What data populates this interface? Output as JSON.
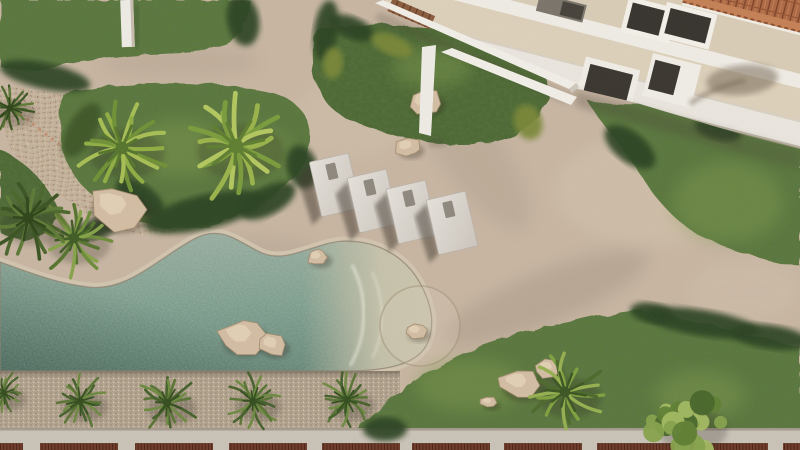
{
  "scene": {
    "title": "Resort courtyard aerial render",
    "description": "Top-down 3D architectural rendering of a resort garden: free-form pool with boulders, four sun loungers on sand, palm trees, lawns, a white building with terracotta tile roof, and a palm-lined pebble promenade with red pergola bays",
    "view": "top-down aerial",
    "style": "photorealistic 3D render"
  },
  "palette": {
    "sand": "#c8b6a3",
    "sand_light": "#d8c9b3",
    "sand_shadow": "#8f8273",
    "grass_mid": "#5a783e",
    "grass_dark": "#4c6833",
    "bush_dark": "#2c4220",
    "bush_olive": "#3c5526",
    "bush_yellow": "#7a8838",
    "water": "#7b9c8c",
    "water_deep": "#2c483e",
    "coping": "#d2c5b0",
    "pebble": "#b3a490",
    "gravel": "#c3b29c",
    "walkway": "#cac3b8",
    "pergola_red": "#6e3a28",
    "building_wall": "#efece5",
    "building_terrace": "#ddd1bc",
    "opening_dark": "#36332e",
    "roof_terracotta": "#ad6844",
    "rock": "#d3bea4",
    "lounger": "#ddd8d1",
    "beam_white": "#f2efe9"
  },
  "palettes": {
    "bright": [
      "#8fae43",
      "#6f9136",
      "#a7bf55",
      "#55752c"
    ],
    "bright2": [
      "#9ab44a",
      "#7a9c3c",
      "#b3c75f",
      "#5e7e30"
    ],
    "mid": [
      "#6d8c3a",
      "#55742e",
      "#86a348",
      "#3f5c24"
    ],
    "darkset": [
      "#4a662c",
      "#3a5322",
      "#5d7a36",
      "#2e4419"
    ],
    "prom": [
      "#587434",
      "#43602a",
      "#6d8a40",
      "#334d1e"
    ],
    "mixed": [
      "#7fa03f",
      "#4c682c",
      "#95b050",
      "#3a5522"
    ],
    "tree": [
      "#86a24c",
      "#5f7f34",
      "#a3bb62",
      "#47662a"
    ]
  },
  "pool": {
    "path": "M0,262 C28,272 55,283 88,287 C128,292 158,258 196,238 C222,225 238,242 262,253 C288,264 315,242 345,241 C382,241 408,260 421,285 C432,305 436,327 426,346 C415,365 385,371 345,371 L0,371 Z",
    "water": "#7b9c8c",
    "boulders_in_pool": 2,
    "beach_entry_side": "right"
  },
  "terrain": {
    "grass_tones": {
      "mid": "#5a783e",
      "dark": "#4c6833"
    },
    "grass_paths": [
      {
        "name": "lawn-top-left",
        "tone": "mid",
        "d": "M0,0 L250,0 C246,18 248,34 232,44 C196,58 150,50 98,60 C58,66 28,76 0,66 Z"
      },
      {
        "name": "lawn-palm-island",
        "tone": "mid",
        "d": "M64,96 C120,78 205,80 266,92 C306,100 316,126 306,156 C296,188 266,204 228,220 C198,234 158,231 128,217 C94,201 68,178 62,148 C58,128 58,108 64,96 Z"
      },
      {
        "name": "lawn-left-edge",
        "tone": "dark",
        "d": "M0,150 C20,158 40,176 52,196 C60,212 58,228 44,236 C30,242 12,240 0,232 Z"
      },
      {
        "name": "lawn-top-middle",
        "tone": "dark",
        "d": "M318,30 C358,22 420,24 468,34 C510,42 545,58 548,88 C550,116 524,136 490,142 C448,150 392,138 354,122 C330,112 317,95 314,72 C312,55 312,38 318,30 Z"
      },
      {
        "name": "lawn-right",
        "tone": "mid",
        "d": "M585,98 C620,112 650,100 688,108 C720,114 754,132 800,146 L800,266 C765,260 735,252 708,240 C678,226 652,196 636,168 C620,142 598,120 585,98 Z"
      },
      {
        "name": "lawn-bottom",
        "tone": "mid",
        "d": "M357,430 C378,402 418,376 456,356 C496,336 540,329 576,321 C606,314 628,309 646,311 L800,346 L800,430 Z"
      }
    ],
    "gravel_path": "M0,90 C35,84 68,94 88,112 C120,142 160,180 182,204 C192,218 186,232 170,234 C150,236 128,234 112,226 C70,205 30,180 12,150 C2,132 0,110 0,90 Z",
    "highlights": [
      {
        "x": 728,
        "y": 202,
        "rx": 55,
        "ry": 40
      },
      {
        "x": 180,
        "y": 148,
        "rx": 48,
        "ry": 28
      },
      {
        "x": 432,
        "y": 68,
        "rx": 40,
        "ry": 20
      },
      {
        "x": 470,
        "y": 385,
        "rx": 55,
        "ry": 26
      },
      {
        "x": 700,
        "y": 395,
        "rx": 45,
        "ry": 24
      },
      {
        "x": 250,
        "y": 150,
        "rx": 40,
        "ry": 24
      }
    ]
  },
  "promenade": {
    "pebble_top": 371,
    "walkway_top": 428,
    "bay_top": 443.4,
    "bay_height": 6.8,
    "bay_width": 78,
    "bay_starts": [
      -55,
      40,
      135,
      229,
      322,
      412,
      504,
      597,
      690,
      783
    ],
    "palm_count": 5
  },
  "building": {
    "wall": "#efece5",
    "terrace": "#ddd1bc",
    "terrace_upper": "#e2d7c3",
    "opening": "#36332e",
    "roof": "#ad6844",
    "roof_rib": "#7d4127",
    "roof_ridge": "#c58055",
    "angle_deg": 14.3,
    "window_count": 4
  },
  "objects": {
    "sand_circle": {
      "x": 420,
      "y": 326,
      "r": 40
    },
    "bushes": [
      {
        "x": 243,
        "y": 20,
        "rx": 16,
        "ry": 26,
        "rot": -10,
        "c": "dark"
      },
      {
        "x": 326,
        "y": 30,
        "rx": 12,
        "ry": 30,
        "rot": 8,
        "c": "dark"
      },
      {
        "x": 333,
        "y": 63,
        "rx": 10,
        "ry": 16,
        "rot": 5,
        "c": "yellow"
      },
      {
        "x": 352,
        "y": 28,
        "rx": 24,
        "ry": 11,
        "rot": 22,
        "c": "dark"
      },
      {
        "x": 392,
        "y": 45,
        "rx": 22,
        "ry": 10,
        "rot": 22,
        "c": "yellow"
      },
      {
        "x": 528,
        "y": 122,
        "rx": 14,
        "ry": 18,
        "rot": -20,
        "c": "yellow"
      },
      {
        "x": 45,
        "y": 76,
        "rx": 46,
        "ry": 13,
        "rot": 12,
        "c": "dark"
      },
      {
        "x": 82,
        "y": 130,
        "rx": 14,
        "ry": 30,
        "rot": 30,
        "c": "olive"
      },
      {
        "x": 140,
        "y": 198,
        "rx": 28,
        "ry": 14,
        "rot": 35,
        "c": "dark"
      },
      {
        "x": 205,
        "y": 212,
        "rx": 62,
        "ry": 17,
        "rot": -13,
        "c": "dark"
      },
      {
        "x": 268,
        "y": 201,
        "rx": 30,
        "ry": 14,
        "rot": -28,
        "c": "dark"
      },
      {
        "x": 302,
        "y": 167,
        "rx": 15,
        "ry": 22,
        "rot": -15,
        "c": "dark"
      },
      {
        "x": 98,
        "y": 228,
        "rx": 26,
        "ry": 10,
        "rot": -18,
        "c": "dark"
      },
      {
        "x": 630,
        "y": 147,
        "rx": 30,
        "ry": 15,
        "rot": 38,
        "c": "dark"
      },
      {
        "x": 718,
        "y": 130,
        "rx": 24,
        "ry": 10,
        "rot": 14,
        "c": "dark"
      },
      {
        "x": 652,
        "y": 313,
        "rx": 22,
        "ry": 10,
        "rot": 9,
        "c": "dark"
      },
      {
        "x": 702,
        "y": 323,
        "rx": 58,
        "ry": 13,
        "rot": 9,
        "c": "dark"
      },
      {
        "x": 770,
        "y": 337,
        "rx": 40,
        "ry": 12,
        "rot": 8,
        "c": "dark"
      },
      {
        "x": 385,
        "y": 429,
        "rx": 22,
        "ry": 12,
        "rot": 0,
        "c": "dark"
      }
    ],
    "rocks": [
      {
        "x": 425,
        "y": 102,
        "rx": 18,
        "ry": 14,
        "seed": 2
      },
      {
        "x": 408,
        "y": 147,
        "rx": 14,
        "ry": 10,
        "seed": 4
      },
      {
        "x": 318,
        "y": 257,
        "rx": 12,
        "ry": 9,
        "seed": 6
      },
      {
        "x": 416,
        "y": 331,
        "rx": 12,
        "ry": 9,
        "seed": 8
      },
      {
        "x": 243,
        "y": 337,
        "rx": 25,
        "ry": 20,
        "seed": 10
      },
      {
        "x": 273,
        "y": 345,
        "rx": 15,
        "ry": 12,
        "seed": 12
      },
      {
        "x": 118,
        "y": 209,
        "rx": 32,
        "ry": 26,
        "seed": 14
      },
      {
        "x": 521,
        "y": 384,
        "rx": 23,
        "ry": 17,
        "seed": 16
      },
      {
        "x": 548,
        "y": 369,
        "rx": 14,
        "ry": 11,
        "seed": 18
      },
      {
        "x": 489,
        "y": 402,
        "rx": 9,
        "ry": 6,
        "seed": 20
      }
    ],
    "loungers": {
      "width": 40,
      "height": 56,
      "rotation": -13,
      "color": "#ddd8d1",
      "slot": "#8e887f",
      "shadow": "#41382e",
      "positions": [
        {
          "x": 335,
          "y": 185
        },
        {
          "x": 373,
          "y": 201
        },
        {
          "x": 412,
          "y": 212
        },
        {
          "x": 452,
          "y": 223
        }
      ]
    },
    "palms": [
      {
        "x": 122,
        "y": 148,
        "r": 48,
        "type": "palm",
        "seed": 11,
        "cols": "bright"
      },
      {
        "x": 236,
        "y": 146,
        "r": 56,
        "type": "palm",
        "seed": 7,
        "cols": "bright2"
      },
      {
        "x": 74,
        "y": 238,
        "r": 40,
        "type": "palm",
        "seed": 5,
        "cols": "mid"
      },
      {
        "x": 28,
        "y": 218,
        "r": 42,
        "type": "palm",
        "seed": 9,
        "cols": "darkset"
      },
      {
        "x": 10,
        "y": 108,
        "r": 26,
        "type": "palm",
        "seed": 3,
        "cols": "darkset"
      },
      {
        "x": 4,
        "y": 393,
        "r": 22,
        "type": "palm",
        "seed": 13,
        "cols": "prom"
      },
      {
        "x": 80,
        "y": 401,
        "r": 29,
        "type": "palm",
        "seed": 17,
        "cols": "prom"
      },
      {
        "x": 167,
        "y": 403,
        "r": 31,
        "type": "palm",
        "seed": 19,
        "cols": "prom"
      },
      {
        "x": 253,
        "y": 401,
        "r": 29,
        "type": "palm",
        "seed": 23,
        "cols": "prom"
      },
      {
        "x": 347,
        "y": 400,
        "r": 29,
        "type": "palm",
        "seed": 29,
        "cols": "prom"
      },
      {
        "x": 565,
        "y": 392,
        "r": 40,
        "type": "palm",
        "seed": 31,
        "cols": "mixed"
      },
      {
        "x": 688,
        "y": 424,
        "r": 44,
        "type": "tree",
        "seed": 37,
        "cols": "tree"
      }
    ]
  }
}
